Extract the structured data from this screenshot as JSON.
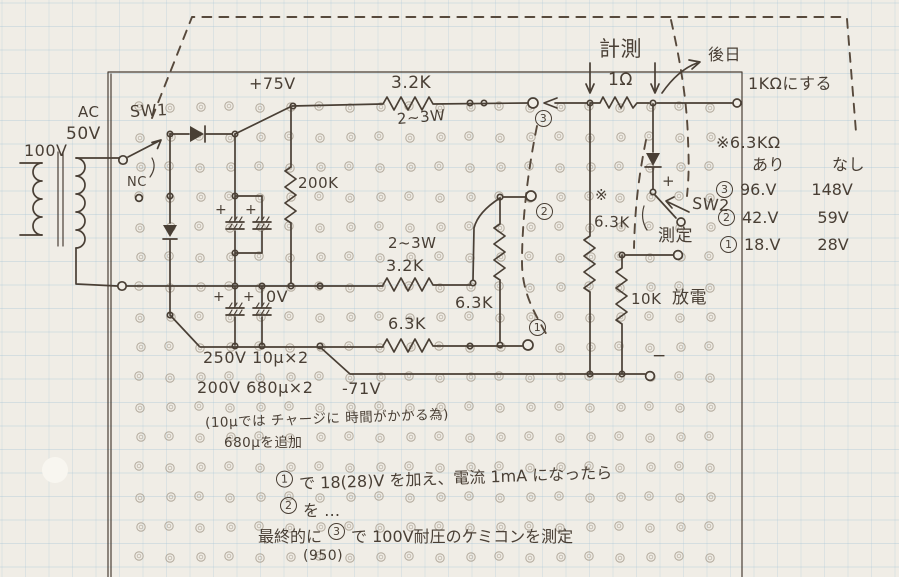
{
  "schematic": {
    "power": {
      "mains": "100V",
      "ac": "AC",
      "ac_voltage": "50V"
    },
    "switch1": {
      "label": "SW1",
      "nc": "NC"
    },
    "rails": {
      "positive": "+75V",
      "zero": "0V",
      "negative": "-71V"
    },
    "resistors": {
      "top_value": "3.2K",
      "top_power": "2~3W",
      "bleeder": "200K",
      "sense": "1Ω",
      "mid_power": "2~3W",
      "mid_value": "3.2K",
      "divider_vertical": "6.3K",
      "divider_horizontal": "6.3K",
      "star_mark": "※",
      "star_value": "6.3K",
      "discharge_value": "10K",
      "discharge_label": "放電"
    },
    "capacitors": {
      "bank1": "250V 10μ×2",
      "bank2": "200V 680μ×2",
      "polarity": "+",
      "note_line1": "(10μでは チャージに 時間がかかる為)",
      "note_line2": "680μを追加"
    },
    "measurement": {
      "heading": "計測",
      "later": "後日",
      "later_detail": "1KΩにする"
    },
    "switch2": {
      "label": "SW2",
      "plus": "+",
      "measure": "測定",
      "minus": "−"
    },
    "test_points": {
      "p3": "3",
      "p2": "2",
      "p1": "1"
    },
    "table": {
      "title": "※6.3KΩ",
      "col_with": "あり",
      "col_without": "なし",
      "rows": [
        {
          "num": "3",
          "with_val": "96.V",
          "without_val": "148V"
        },
        {
          "num": "2",
          "with_val": "42.V",
          "without_val": "59V"
        },
        {
          "num": "1",
          "with_val": "18.V",
          "without_val": "28V"
        }
      ]
    },
    "procedure": {
      "l1_num": "1",
      "l1": "で 18(28)V を加え、電流 1mA になったら",
      "l2_num": "2",
      "l2": "を …",
      "l3_pre": "最終的に",
      "l3_num": "3",
      "l3": "で 100V耐圧のケミコンを測定",
      "l4": "(950)"
    },
    "colors": {
      "ink": "#493f35",
      "paper": "#f0ede6",
      "grid_blue": "#9fc0d4"
    }
  }
}
